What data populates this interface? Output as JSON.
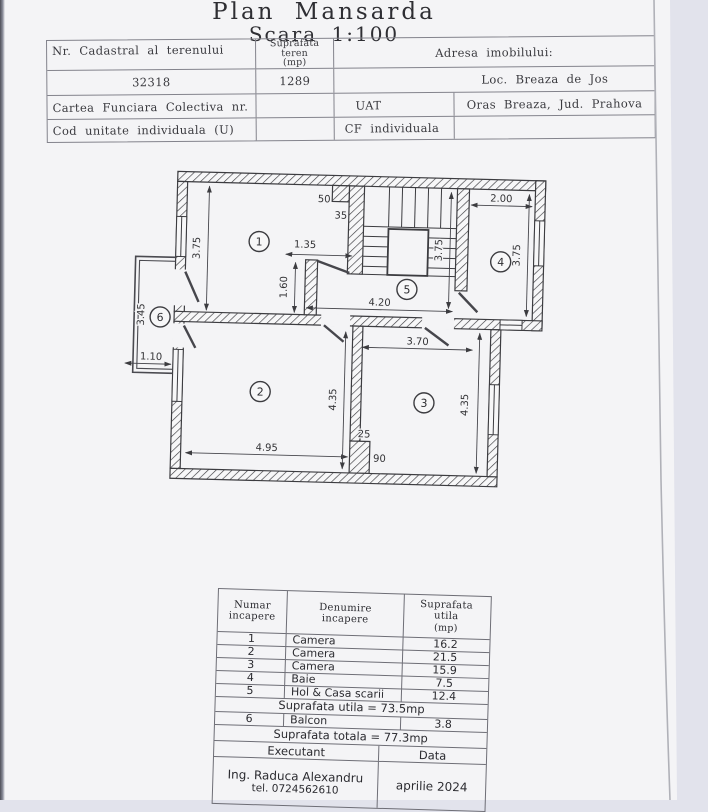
{
  "page": {
    "title": "Plan Mansarda",
    "scale": "Scara 1:100"
  },
  "header_table": {
    "nr_cadastral_label": "Nr. Cadastral al terenului",
    "suprafata_teren_l1": "Suprafata",
    "suprafata_teren_l2": "teren",
    "suprafata_teren_l3": "(mp)",
    "adresa_label": "Adresa imobilului:",
    "nr_cadastral_value": "32318",
    "suprafata_teren_value": "1289",
    "adresa_value": "Loc. Breaza de Jos",
    "cartea_funciara_label": "Cartea Funciara Colectiva nr.",
    "uat_label": "UAT",
    "uat_value": "Oras Breaza, Jud. Prahova",
    "cod_unitate_label": "Cod unitate individuala (U)",
    "cf_label": "CF individuala"
  },
  "plan": {
    "rooms": [
      {
        "n": "1",
        "x": 121,
        "y": 68
      },
      {
        "n": "2",
        "x": 126,
        "y": 218
      },
      {
        "n": "3",
        "x": 290,
        "y": 225
      },
      {
        "n": "4",
        "x": 363,
        "y": 82
      },
      {
        "n": "5",
        "x": 270,
        "y": 112
      },
      {
        "n": "6",
        "x": 24,
        "y": 146
      }
    ],
    "dims": [
      {
        "text": "3.75",
        "x": 62,
        "y": 76,
        "rot": -90
      },
      {
        "text": "50",
        "x": 185,
        "y": 27,
        "rot": 0
      },
      {
        "text": "35",
        "x": 202,
        "y": 43,
        "rot": 0
      },
      {
        "text": "1.35",
        "x": 167,
        "y": 73,
        "rot": 0
      },
      {
        "text": "1.60",
        "x": 150,
        "y": 113,
        "rot": -90
      },
      {
        "text": "2.00",
        "x": 362,
        "y": 22,
        "rot": 0
      },
      {
        "text": "3.75",
        "x": 382,
        "y": 75,
        "rot": -90
      },
      {
        "text": "3.75",
        "x": 304,
        "y": 72,
        "rot": -90
      },
      {
        "text": "4.20",
        "x": 243,
        "y": 129,
        "rot": 0
      },
      {
        "text": "3.45",
        "x": 8,
        "y": 144,
        "rot": -90
      },
      {
        "text": "1.10",
        "x": 16,
        "y": 189,
        "rot": 0
      },
      {
        "text": "4.95",
        "x": 134,
        "y": 277,
        "rot": 0
      },
      {
        "text": "4.35",
        "x": 202,
        "y": 224,
        "rot": -90
      },
      {
        "text": "25",
        "x": 231,
        "y": 261,
        "rot": 0
      },
      {
        "text": "90",
        "x": 247,
        "y": 285,
        "rot": 0
      },
      {
        "text": "3.70",
        "x": 282,
        "y": 167,
        "rot": 0
      },
      {
        "text": "4.35",
        "x": 334,
        "y": 226,
        "rot": -90
      }
    ]
  },
  "rooms_table": {
    "header": {
      "numar_l1": "Numar",
      "numar_l2": "incapere",
      "denumire_l1": "Denumire",
      "denumire_l2": "incapere",
      "suprafata_l1": "Suprafata",
      "suprafata_l2": "utila",
      "suprafata_l3": "(mp)"
    },
    "rows": [
      {
        "nr": "1",
        "name": "Camera",
        "mp": "16.2"
      },
      {
        "nr": "2",
        "name": "Camera",
        "mp": "21.5"
      },
      {
        "nr": "3",
        "name": "Camera",
        "mp": "15.9"
      },
      {
        "nr": "4",
        "name": "Baie",
        "mp": "7.5"
      },
      {
        "nr": "5",
        "name": "Hol & Casa scarii",
        "mp": "12.4"
      }
    ],
    "utila_total": "Suprafata utila = 73.5mp",
    "row6": {
      "nr": "6",
      "name": "Balcon",
      "mp": "3.8"
    },
    "total": "Suprafata totala = 77.3mp",
    "executant_label": "Executant",
    "data_label": "Data",
    "executant_name": "Ing. Raduca Alexandru",
    "executant_tel": "tel. 0724562610",
    "date_value": "aprilie 2024"
  }
}
